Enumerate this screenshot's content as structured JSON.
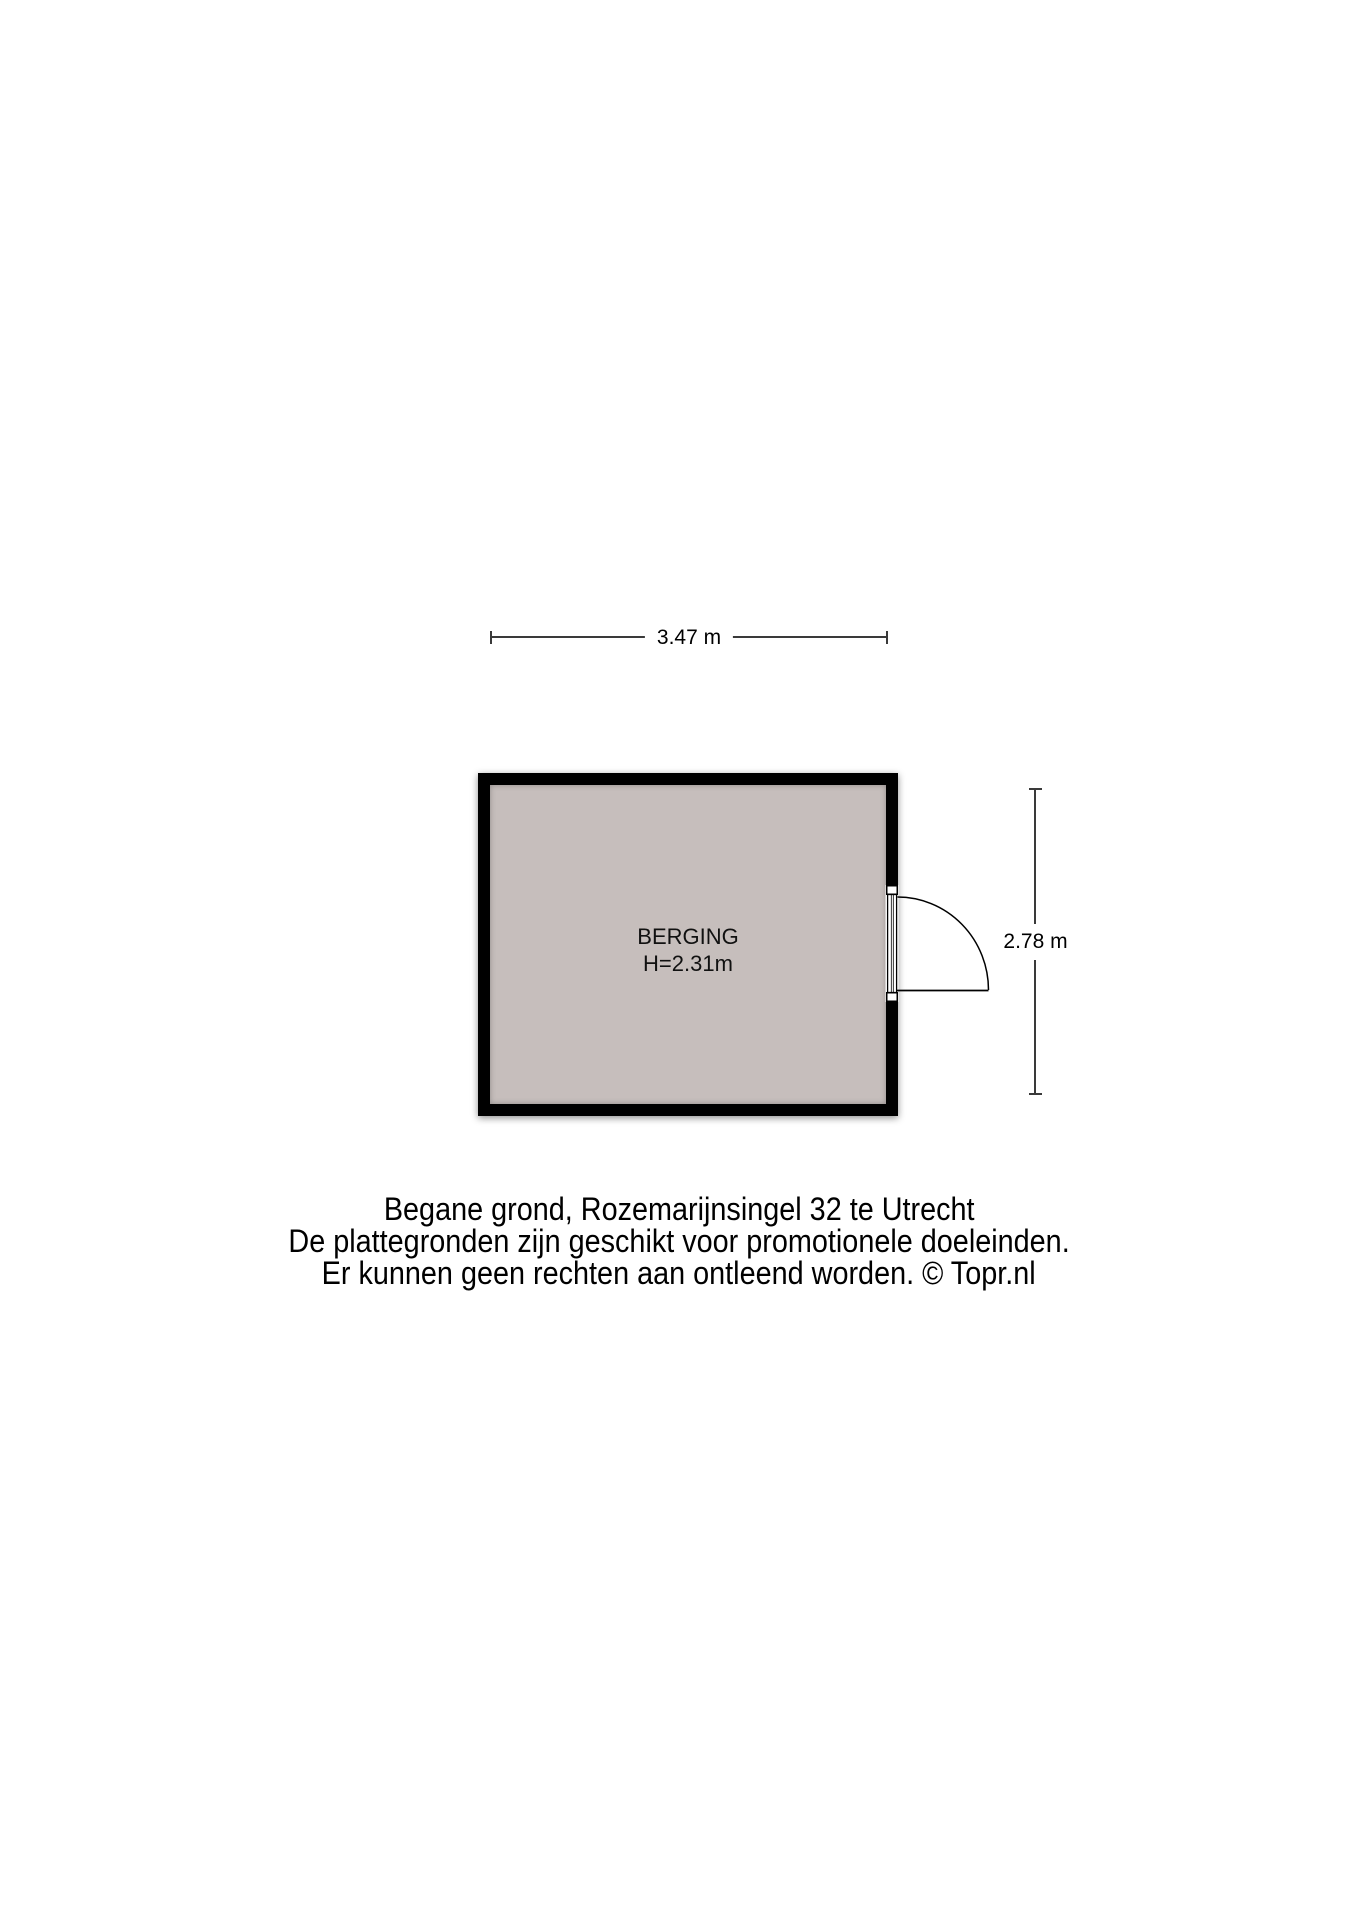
{
  "floorplan": {
    "room": {
      "name_label": "BERGING",
      "ceiling_height_label": "H=2.31m",
      "fill_color": "#c6bebc",
      "wall_color": "#000000"
    },
    "dimensions": {
      "width_label": "3.47 m",
      "height_label": "2.78 m"
    },
    "door": {
      "icon": "door-swing-icon",
      "wall": "right",
      "swing": "outward-quarter-circle"
    },
    "caption": {
      "line1": "Begane grond, Rozemarijnsingel 32 te Utrecht",
      "line2": "De plattegronden zijn geschikt voor promotionele doeleinden.",
      "line3": "Er kunnen geen rechten aan ontleend worden. © Topr.nl"
    }
  }
}
